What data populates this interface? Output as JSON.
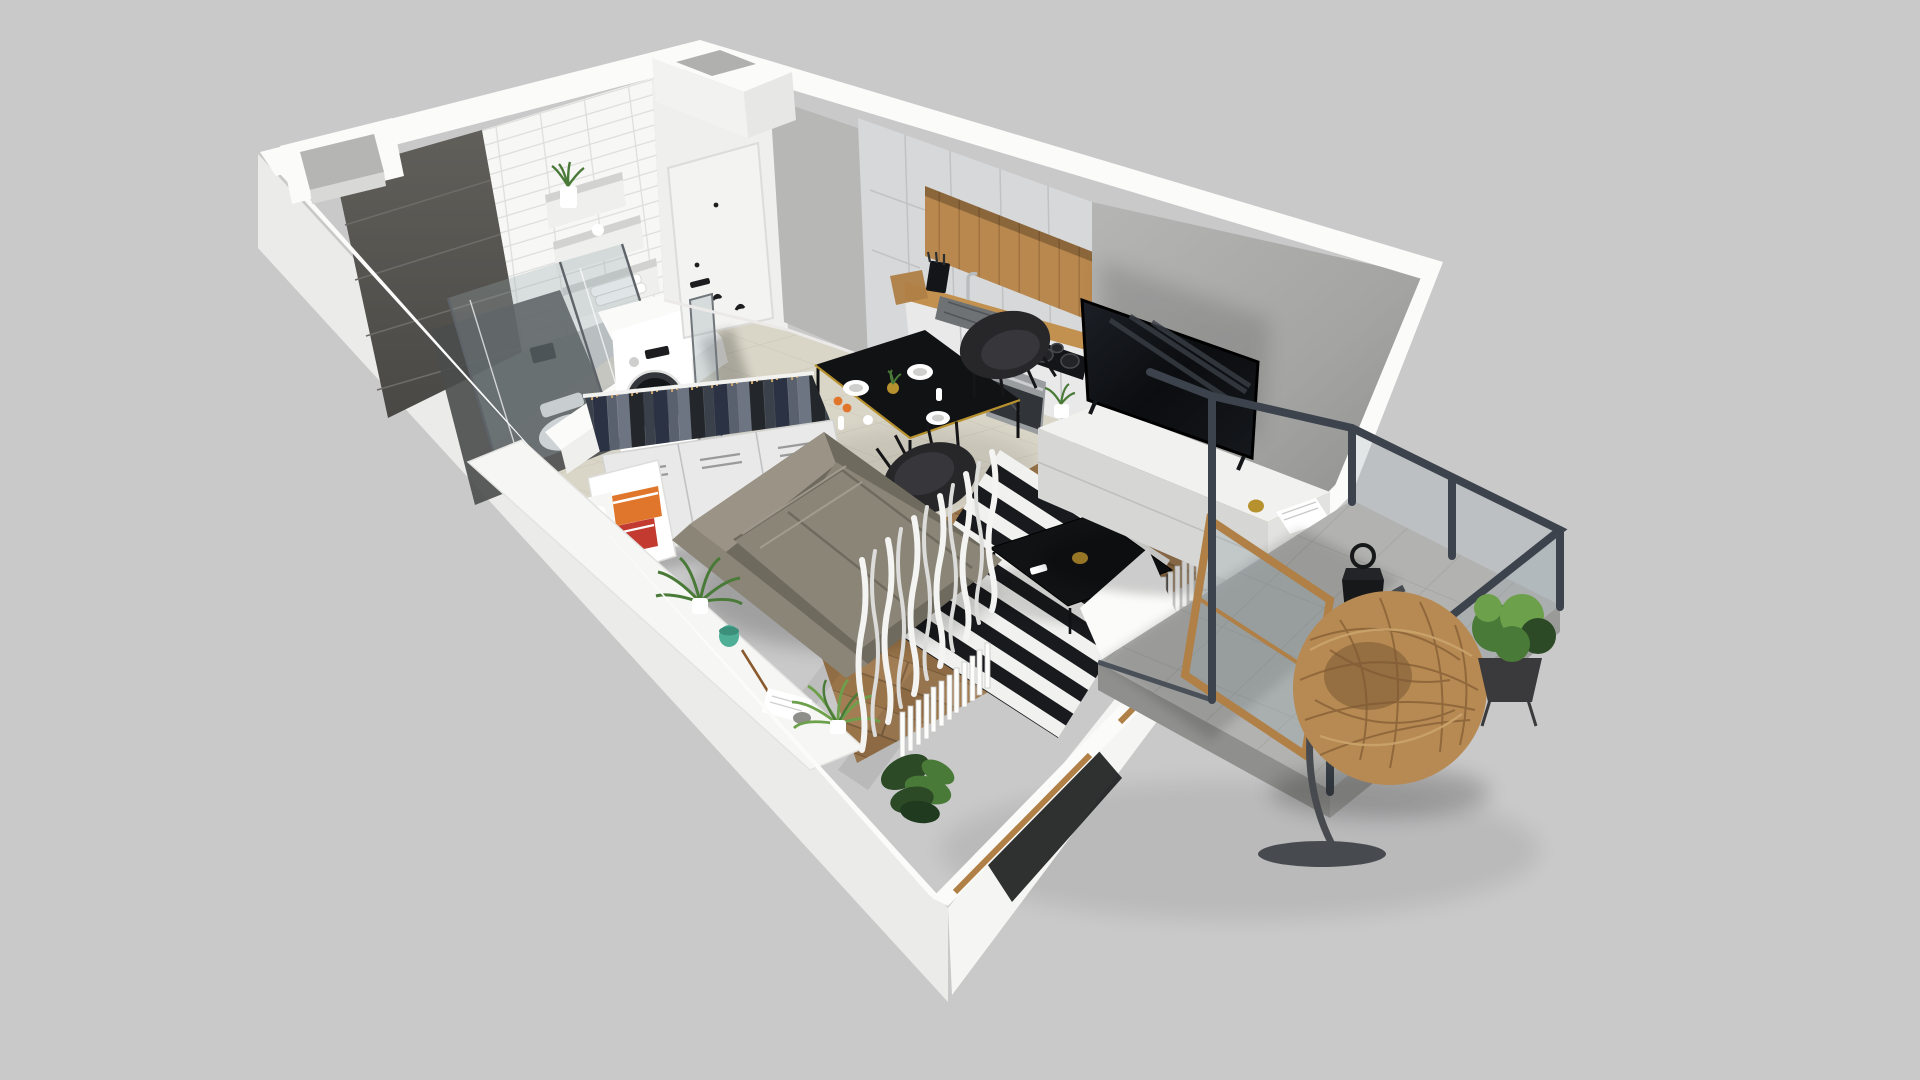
{
  "scene": {
    "label": "3D isometric cutaway floor-plan render of a small studio apartment with a balcony, viewed from above on a plain light-gray background",
    "view": "axonometric top-down cutaway, no visible text",
    "rooms": [
      {
        "name": "bathroom",
        "items": [
          "white subway-tile wall",
          "dark graphite accent tile wall",
          "wall niche shelves with plant, cup and towels",
          "glass shower enclosure",
          "wall-hung toilet",
          "washing machine"
        ]
      },
      {
        "name": "hallway",
        "items": [
          "white entry door with black handle",
          "black wall hooks",
          "leaning mirror panel"
        ]
      },
      {
        "name": "kitchen",
        "items": [
          "light-gray flat-front cabinets",
          "oak open niche shelf",
          "wood worktop",
          "gray sink with chrome tap",
          "black induction hob",
          "built-in stainless oven",
          "cutting board",
          "knife block",
          "pepper mills"
        ]
      },
      {
        "name": "dining-area",
        "items": [
          "black dining table with gold trim",
          "two black shell chairs",
          "plates, cups and fruit"
        ]
      },
      {
        "name": "wardrobe",
        "items": [
          "open rail with dark hanging clothes on wooden hangers",
          "white sideboard cabinet",
          "end shelf with orange and red books and a mug"
        ]
      },
      {
        "name": "living-area",
        "items": [
          "taupe-gray fabric sofa",
          "black and white striped rug",
          "black coffee table with gold jar",
          "white TV sideboard with plant, gold cup and magazines",
          "flat TV against gray feature wall",
          "white console shelf with fern, monstera, teal cup and papers",
          "sheer white curtains",
          "white column radiators",
          "oak-framed balcony door"
        ]
      },
      {
        "name": "balcony",
        "items": [
          "concrete-look tile floor",
          "charcoal steel railing frame with glass",
          "hanging rattan egg chair on curved stand",
          "black candle lantern",
          "potted green plant on stand"
        ]
      }
    ]
  },
  "palette": {
    "bg": "#c9c9ca",
    "wallBand": "#fbfbfa",
    "wallExtShade": "#ebebe9",
    "wallExtLight": "#f5f5f3",
    "wallInner": "#efefed",
    "grayFaceSoft": "#b7b7b6",
    "accentTile": "#575551",
    "accentTileSeam": "#6e6c68",
    "tileWall": "#f7f7f5",
    "tileWallLine": "#dddddb",
    "doorWhite": "#f3f3f1",
    "doorHardware": "#1d1d1f",
    "floorTile": "#d9d5c7",
    "floorTileLine": "#c8c4b6",
    "floorWood": "#a37e55",
    "floorWoodDark": "#997449",
    "floorWoodLine": "#7b5e3e",
    "cabinet": "#d7d8da",
    "cabinetSeam": "#c1c2c4",
    "cabinetWhite": "#e9e9e9",
    "oak": "#b9884e",
    "oakDark": "#9e7240",
    "counterWood": "#c2914f",
    "steelAppliance": "#9a9da0",
    "ovenGlass": "#313438",
    "cooktop": "#141518",
    "sinkGray": "#6e7275",
    "tvScreen": "#0f1114",
    "tvStand": "#f1f1ef",
    "sofa": "#8b8578",
    "sofaDark": "#6f6a5e",
    "sofaLight": "#9b9486",
    "rugLight": "#f1f1ef",
    "rugDark": "#191a1d",
    "tableBlack": "#101214",
    "gold": "#b8912f",
    "chairBlack": "#27272a",
    "clothesA": "#23262b",
    "clothesB": "#3a414b",
    "clothesC": "#59616e",
    "clothesD": "#2b3243",
    "clothesE": "#6e7582",
    "rattan": "#b68a52",
    "rattanDark": "#8a6238",
    "railSteel": "#3c434c",
    "balconyTile": "#b2b2b0",
    "balconyTileLine": "#a2a29f",
    "glass": "rgba(150,165,172,0.30)",
    "glassDark": "#1d1f21",
    "greenLight": "#6da04b",
    "green": "#4a7a38",
    "greenDark": "#2c4a26",
    "teal": "#4fae96",
    "orange": "#e0752c",
    "red": "#c23a30",
    "white": "#ffffff",
    "paper": "#f6f6f4",
    "stone": "#8e8e8a",
    "woodFrame": "#b08046"
  }
}
